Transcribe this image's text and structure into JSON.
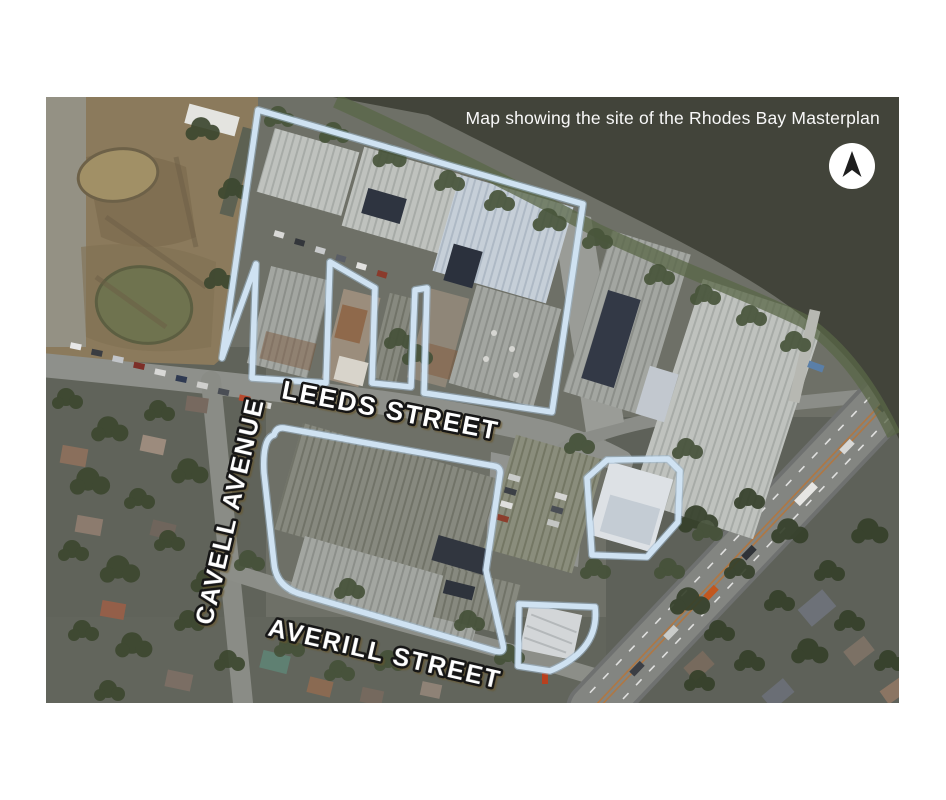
{
  "map": {
    "caption": "Map showing the site of the Rhodes Bay Masterplan",
    "streets": {
      "leeds": "LEEDS STREET",
      "cavell": "CAVELL AVENUE",
      "averill": "AVERILL STREET"
    },
    "north_indicator_icon": "north-arrow",
    "colors": {
      "site_outline": "#cfe2f2",
      "site_outline_edge": "#9fb9cf",
      "water": "#42443a",
      "label_fill": "#ffffff",
      "label_stroke": "#161616",
      "caption_text": "#f8f8f8"
    }
  }
}
